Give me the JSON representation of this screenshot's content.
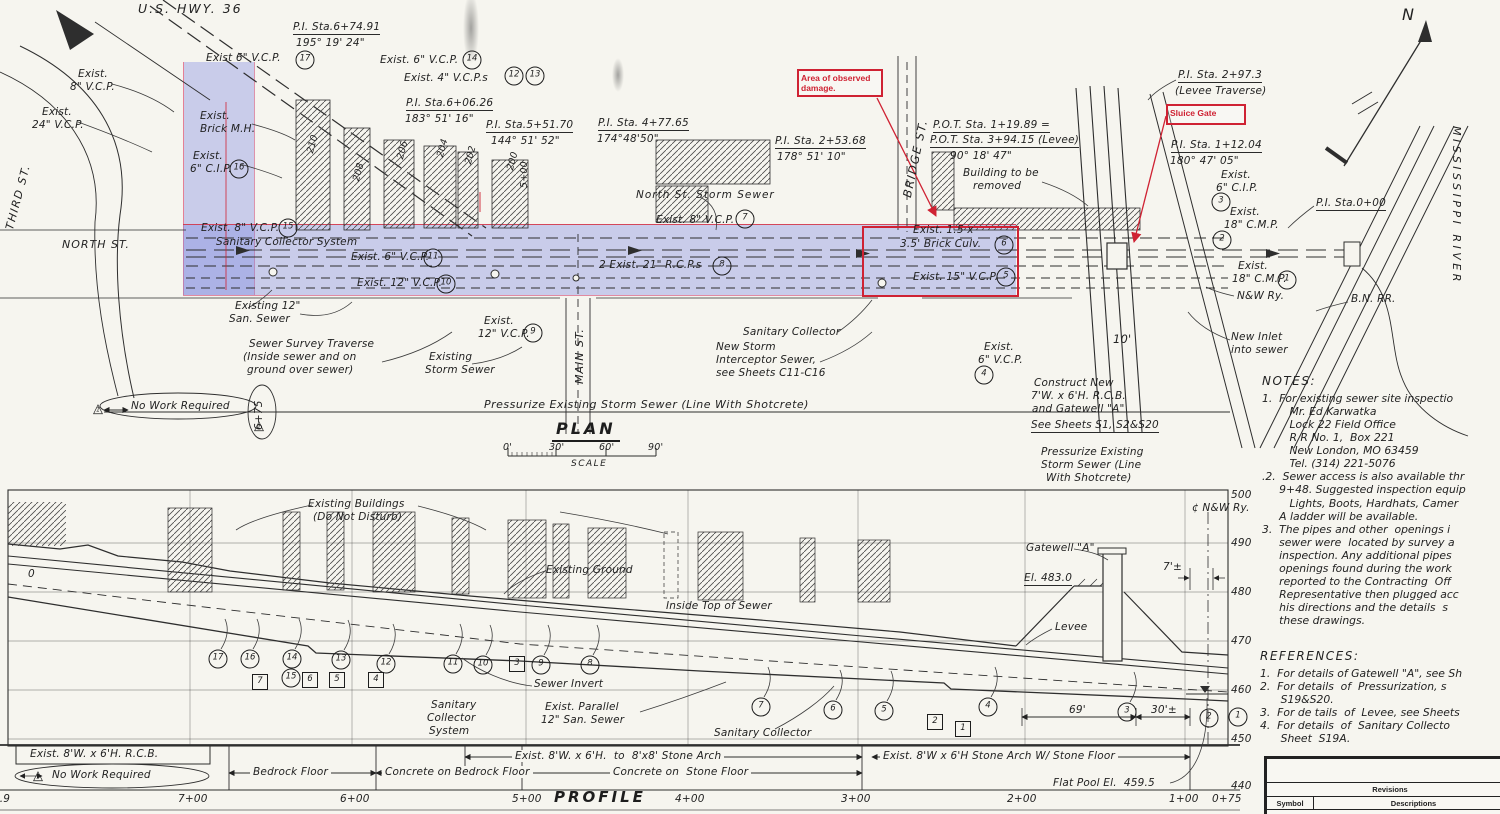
{
  "annotations": {
    "damage_label": "Area of observed damage.",
    "sluice_label": "Sluice Gate",
    "accent_red": "#cf2233",
    "highlight_blue": "rgba(122,132,224,0.36)"
  },
  "plan": {
    "title": "PLAN",
    "scale_label": "SCALE",
    "scale_ticks": [
      {
        "t": "0'",
        "x": 503
      },
      {
        "t": "30'",
        "x": 549
      },
      {
        "t": "60'",
        "x": 599
      },
      {
        "t": "90'",
        "x": 648
      }
    ],
    "labels": [
      {
        "t": "U.S. HWY. 36",
        "x": 138,
        "y": 2,
        "fs": 12.5,
        "ls": 2
      },
      {
        "t": "THIRD ST.",
        "x": 4,
        "y": 228,
        "r": -75,
        "fs": 11,
        "ls": 1.5
      },
      {
        "t": "Exist.",
        "x": 78,
        "y": 68
      },
      {
        "t": "8\" V.C.P.",
        "x": 70,
        "y": 81
      },
      {
        "t": "Exist.",
        "x": 42,
        "y": 106
      },
      {
        "t": "24\" V.C.P.",
        "x": 32,
        "y": 119
      },
      {
        "t": "Exist 6\" V.C.P.",
        "x": 206,
        "y": 52
      },
      {
        "t": "P.I. Sta.6+74.91",
        "x": 293,
        "y": 21,
        "u": 1
      },
      {
        "t": "195° 19' 24\"",
        "x": 296,
        "y": 37
      },
      {
        "t": "Exist. 6\" V.C.P.",
        "x": 380,
        "y": 54
      },
      {
        "t": "Exist. 4\" V.C.P.s",
        "x": 404,
        "y": 72
      },
      {
        "t": "P.I. Sta.6+06.26",
        "x": 406,
        "y": 97,
        "u": 1
      },
      {
        "t": "183° 51' 16\"",
        "x": 405,
        "y": 113
      },
      {
        "t": "P.I. Sta.5+51.70",
        "x": 486,
        "y": 119,
        "u": 1
      },
      {
        "t": "144° 51' 52\"",
        "x": 491,
        "y": 135
      },
      {
        "t": "P.I. Sta. 4+77.65",
        "x": 598,
        "y": 117,
        "u": 1
      },
      {
        "t": "174°48'50\"",
        "x": 597,
        "y": 133
      },
      {
        "t": "P.I. Sta. 2+53.68",
        "x": 775,
        "y": 135,
        "u": 1
      },
      {
        "t": "178° 51' 10\"",
        "x": 777,
        "y": 151
      },
      {
        "t": "Exist.",
        "x": 200,
        "y": 110
      },
      {
        "t": "Brick M.H.",
        "x": 200,
        "y": 123
      },
      {
        "t": "Exist.",
        "x": 193,
        "y": 150
      },
      {
        "t": "6\" C.I.P.",
        "x": 190,
        "y": 163
      },
      {
        "t": "Exist. 8\" V.C.P.",
        "x": 201,
        "y": 222
      },
      {
        "t": "Sanitary Collector System",
        "x": 216,
        "y": 236
      },
      {
        "t": "Exist. 6\" V.C.P.",
        "x": 351,
        "y": 251
      },
      {
        "t": "Exist. 12\" V.C.P.",
        "x": 357,
        "y": 277
      },
      {
        "t": "NORTH ST.",
        "x": 62,
        "y": 239,
        "fs": 11,
        "ls": 1
      },
      {
        "t": "Existing 12\"",
        "x": 235,
        "y": 300
      },
      {
        "t": "San. Sewer",
        "x": 229,
        "y": 313
      },
      {
        "t": "Sewer Survey Traverse",
        "x": 249,
        "y": 338
      },
      {
        "t": "(Inside sewer and on",
        "x": 243,
        "y": 351
      },
      {
        "t": "ground over sewer)",
        "x": 247,
        "y": 364
      },
      {
        "t": "Exist.",
        "x": 484,
        "y": 315
      },
      {
        "t": "12\" V.C.P.",
        "x": 478,
        "y": 328
      },
      {
        "t": "Existing",
        "x": 429,
        "y": 351
      },
      {
        "t": "Storm Sewer",
        "x": 425,
        "y": 364
      },
      {
        "t": "MAIN ST.",
        "x": 574,
        "y": 384,
        "r": -90,
        "fs": 11,
        "ls": 1
      },
      {
        "t": "North St. Storm Sewer",
        "x": 636,
        "y": 189,
        "ls": 1
      },
      {
        "t": "Exist. 8\" V.C.P.",
        "x": 656,
        "y": 214
      },
      {
        "t": "2 Exist. 21\" R.C.P.s",
        "x": 599,
        "y": 259
      },
      {
        "t": "Sanitary Collector",
        "x": 743,
        "y": 326
      },
      {
        "t": "New Storm",
        "x": 716,
        "y": 341
      },
      {
        "t": "Interceptor Sewer,",
        "x": 716,
        "y": 354
      },
      {
        "t": "see Sheets C11-C16",
        "x": 716,
        "y": 367
      },
      {
        "t": "BRIDGE ST.",
        "x": 901,
        "y": 196,
        "r": -78,
        "fs": 11.5,
        "ls": 1.5
      },
      {
        "t": "P.O.T. Sta. 1+19.89 =",
        "x": 933,
        "y": 119,
        "u": 1
      },
      {
        "t": "P.O.T. Sta. 3+94.15 (Levee)",
        "x": 930,
        "y": 134,
        "u": 1
      },
      {
        "t": "90° 18' 47\"",
        "x": 950,
        "y": 150
      },
      {
        "t": "Building to be",
        "x": 963,
        "y": 167
      },
      {
        "t": "removed",
        "x": 973,
        "y": 180
      },
      {
        "t": "Exist. 1.5 x",
        "x": 913,
        "y": 224
      },
      {
        "t": "3.5' Brick Culv.",
        "x": 900,
        "y": 238
      },
      {
        "t": "Exist. 15\" V.C.P.",
        "x": 913,
        "y": 271
      },
      {
        "t": "Exist.",
        "x": 984,
        "y": 341
      },
      {
        "t": "6\" V.C.P.",
        "x": 978,
        "y": 354
      },
      {
        "t": "Construct New",
        "x": 1034,
        "y": 377
      },
      {
        "t": "7'W. x 6'H. R.C.B.",
        "x": 1031,
        "y": 390
      },
      {
        "t": "and Gatewell \"A\"",
        "x": 1032,
        "y": 403
      },
      {
        "t": "See Sheets S1, S2&S20",
        "x": 1031,
        "y": 419,
        "u": 1
      },
      {
        "t": "Pressurize Existing",
        "x": 1041,
        "y": 446
      },
      {
        "t": "Storm Sewer (Line",
        "x": 1041,
        "y": 459
      },
      {
        "t": "With Shotcrete)",
        "x": 1046,
        "y": 472
      },
      {
        "t": "10'",
        "x": 1113,
        "y": 333,
        "fs": 11.5
      },
      {
        "t": "P.I. Sta. 2+97.3",
        "x": 1178,
        "y": 69,
        "u": 1
      },
      {
        "t": "(Levee Traverse)",
        "x": 1175,
        "y": 85
      },
      {
        "t": "P.I. Sta. 1+12.04",
        "x": 1171,
        "y": 139,
        "u": 1
      },
      {
        "t": "180° 47' 05\"",
        "x": 1170,
        "y": 155
      },
      {
        "t": "Exist.",
        "x": 1221,
        "y": 169
      },
      {
        "t": "6\" C.I.P.",
        "x": 1216,
        "y": 182
      },
      {
        "t": "Exist.",
        "x": 1230,
        "y": 206
      },
      {
        "t": "18\" C.M.P.",
        "x": 1224,
        "y": 219
      },
      {
        "t": "P.I. Sta.0+00",
        "x": 1316,
        "y": 197,
        "u": 1
      },
      {
        "t": "Exist.",
        "x": 1238,
        "y": 260
      },
      {
        "t": "18\" C.M.P.",
        "x": 1232,
        "y": 273
      },
      {
        "t": "N&W Ry.",
        "x": 1237,
        "y": 290
      },
      {
        "t": "B.N. RR.",
        "x": 1351,
        "y": 293
      },
      {
        "t": "New Inlet",
        "x": 1231,
        "y": 331
      },
      {
        "t": "into sewer",
        "x": 1231,
        "y": 344
      },
      {
        "t": "MISSISSIPPI RIVER",
        "x": 1462,
        "y": 126,
        "r": 90,
        "fs": 11,
        "ls": 3.5
      },
      {
        "t": "N",
        "x": 1402,
        "y": 6,
        "fs": 16
      },
      {
        "t": "No Work Required",
        "x": 131,
        "y": 400
      },
      {
        "t": "6+75",
        "x": 253,
        "y": 430,
        "r": -90
      },
      {
        "t": "Pressurize Existing Storm Sewer (Line With Shotcrete)",
        "x": 484,
        "y": 399,
        "fs": 11,
        "ls": 0.5
      },
      {
        "t": "210",
        "x": 306,
        "y": 152,
        "r": -75,
        "fs": 9.5
      },
      {
        "t": "208",
        "x": 352,
        "y": 180,
        "r": -75,
        "fs": 9.5
      },
      {
        "t": "206",
        "x": 396,
        "y": 158,
        "r": -75,
        "fs": 9.5
      },
      {
        "t": "204",
        "x": 436,
        "y": 156,
        "r": -75,
        "fs": 9.5
      },
      {
        "t": "202",
        "x": 464,
        "y": 163,
        "r": -75,
        "fs": 9.5
      },
      {
        "t": "200",
        "x": 506,
        "y": 169,
        "r": -75,
        "fs": 9.5
      },
      {
        "t": "5+00",
        "x": 520,
        "y": 188,
        "r": -90,
        "fs": 9.5
      }
    ],
    "markers": [
      {
        "n": "17",
        "x": 305,
        "y": 60
      },
      {
        "n": "14",
        "x": 472,
        "y": 60
      },
      {
        "n": "12",
        "x": 514,
        "y": 76
      },
      {
        "n": "13",
        "x": 535,
        "y": 76
      },
      {
        "n": "16",
        "x": 239,
        "y": 169
      },
      {
        "n": "15",
        "x": 288,
        "y": 228
      },
      {
        "n": "11",
        "x": 433,
        "y": 258
      },
      {
        "n": "10",
        "x": 446,
        "y": 284
      },
      {
        "n": "9",
        "x": 533,
        "y": 333
      },
      {
        "n": "7",
        "x": 745,
        "y": 219
      },
      {
        "n": "8",
        "x": 722,
        "y": 266
      },
      {
        "n": "6",
        "x": 1004,
        "y": 245
      },
      {
        "n": "5",
        "x": 1006,
        "y": 277
      },
      {
        "n": "4",
        "x": 984,
        "y": 375
      },
      {
        "n": "3",
        "x": 1221,
        "y": 202
      },
      {
        "n": "2",
        "x": 1222,
        "y": 240
      },
      {
        "n": "1",
        "x": 1287,
        "y": 280
      },
      {
        "n": "1",
        "x": 98,
        "y": 409,
        "s": "t"
      },
      {
        "n": "1",
        "x": 259,
        "y": 426,
        "s": "t"
      }
    ]
  },
  "profile": {
    "title": "PROFILE",
    "labels": [
      {
        "t": "Existing Buildings",
        "x": 308,
        "y": 498
      },
      {
        "t": "(Do Not Disturb)",
        "x": 313,
        "y": 511
      },
      {
        "t": "Existing Ground",
        "x": 546,
        "y": 564
      },
      {
        "t": "Inside Top of Sewer",
        "x": 666,
        "y": 600
      },
      {
        "t": "Sewer Invert",
        "x": 534,
        "y": 678
      },
      {
        "t": "Sanitary",
        "x": 431,
        "y": 699
      },
      {
        "t": "Collector",
        "x": 427,
        "y": 712
      },
      {
        "t": "System",
        "x": 429,
        "y": 725
      },
      {
        "t": "Exist. Parallel",
        "x": 545,
        "y": 701
      },
      {
        "t": "12\" San. Sewer",
        "x": 541,
        "y": 714
      },
      {
        "t": "Sanitary Collector",
        "x": 714,
        "y": 727
      },
      {
        "t": "Gatewell \"A\"",
        "x": 1026,
        "y": 542
      },
      {
        "t": "El. 483.0",
        "x": 1024,
        "y": 572,
        "u": 1
      },
      {
        "t": "Levee",
        "x": 1055,
        "y": 621
      },
      {
        "t": "7'±",
        "x": 1163,
        "y": 561
      },
      {
        "t": "¢ N&W Ry.",
        "x": 1192,
        "y": 502
      },
      {
        "t": "69'",
        "x": 1066,
        "y": 704,
        "bg": 1
      },
      {
        "t": "30'±",
        "x": 1148,
        "y": 704,
        "bg": 1
      },
      {
        "t": "Flat Pool El.  459.5",
        "x": 1053,
        "y": 777
      },
      {
        "t": "0",
        "x": 28,
        "y": 568
      },
      {
        "t": "Exist. 8'W. x 6'H. R.C.B.",
        "x": 30,
        "y": 748
      },
      {
        "t": "No Work Required",
        "x": 52,
        "y": 769
      },
      {
        "t": "Bedrock Floor",
        "x": 250,
        "y": 766,
        "bg": 1
      },
      {
        "t": "Concrete on Bedrock Floor",
        "x": 382,
        "y": 766,
        "bg": 1
      },
      {
        "t": "Exist. 8'W. x 6'H.  to  8'x8' Stone Arch",
        "x": 512,
        "y": 750,
        "bg": 1
      },
      {
        "t": "Concrete on  Stone Floor",
        "x": 610,
        "y": 766,
        "bg": 1
      },
      {
        "t": "Exist. 8'W x 6'H Stone Arch W/ Stone Floor",
        "x": 880,
        "y": 750,
        "bg": 1
      }
    ],
    "markers": [
      {
        "n": "17",
        "x": 218,
        "y": 659,
        "ld": 1
      },
      {
        "n": "16",
        "x": 250,
        "y": 659,
        "ld": 1
      },
      {
        "n": "14",
        "x": 292,
        "y": 659,
        "ld": 1
      },
      {
        "n": "15",
        "x": 291,
        "y": 678
      },
      {
        "n": "13",
        "x": 341,
        "y": 660,
        "ld": 1
      },
      {
        "n": "12",
        "x": 386,
        "y": 664,
        "ld": 1
      },
      {
        "n": "11",
        "x": 453,
        "y": 664,
        "ld": 1
      },
      {
        "n": "10",
        "x": 483,
        "y": 665,
        "ld": 1
      },
      {
        "n": "9",
        "x": 541,
        "y": 665,
        "ld": 1
      },
      {
        "n": "8",
        "x": 590,
        "y": 665,
        "ld": 1
      },
      {
        "n": "7",
        "x": 761,
        "y": 707,
        "ld": 1
      },
      {
        "n": "6",
        "x": 833,
        "y": 710,
        "ld": 1
      },
      {
        "n": "5",
        "x": 884,
        "y": 711,
        "ld": 1
      },
      {
        "n": "4",
        "x": 988,
        "y": 707,
        "ld": 1
      },
      {
        "n": "3",
        "x": 1127,
        "y": 712,
        "ld": 1
      },
      {
        "n": "2",
        "x": 1209,
        "y": 718
      },
      {
        "n": "1",
        "x": 1238,
        "y": 717
      },
      {
        "n": "7",
        "x": 260,
        "y": 682,
        "s": "q"
      },
      {
        "n": "6",
        "x": 310,
        "y": 680,
        "s": "q"
      },
      {
        "n": "5",
        "x": 337,
        "y": 680,
        "s": "q"
      },
      {
        "n": "4",
        "x": 376,
        "y": 680,
        "s": "q"
      },
      {
        "n": "3",
        "x": 517,
        "y": 664,
        "s": "q"
      },
      {
        "n": "2",
        "x": 935,
        "y": 722,
        "s": "q"
      },
      {
        "n": "1",
        "x": 963,
        "y": 729,
        "s": "q"
      },
      {
        "n": "1",
        "x": 38,
        "y": 776,
        "s": "t"
      }
    ],
    "stations": [
      {
        "t": "92.9",
        "x": -14
      },
      {
        "t": "7+00",
        "x": 178
      },
      {
        "t": "6+00",
        "x": 340
      },
      {
        "t": "5+00",
        "x": 512
      },
      {
        "t": "4+00",
        "x": 675
      },
      {
        "t": "3+00",
        "x": 841
      },
      {
        "t": "2+00",
        "x": 1007
      },
      {
        "t": "1+00",
        "x": 1169
      },
      {
        "t": "0+75",
        "x": 1212
      }
    ],
    "elevations": [
      {
        "t": "500",
        "y": 489
      },
      {
        "t": "490",
        "y": 537
      },
      {
        "t": "480",
        "y": 586
      },
      {
        "t": "470",
        "y": 635
      },
      {
        "t": "460",
        "y": 684
      },
      {
        "t": "450",
        "y": 733
      },
      {
        "t": "440",
        "y": 780
      }
    ]
  },
  "notes": {
    "heading": "NOTES:",
    "lines": [
      "1.  For existing sewer site inspectio",
      "        Mr. Ed Karwatka",
      "        Lock 22 Field Office",
      "        R R No. 1,  Box 221",
      "        New London, MO 63459",
      "        Tel. (314) 221-5076",
      ".2.  Sewer access is also available thr",
      "     9+48. Suggested inspection equip",
      "        Lights, Boots, Hardhats, Camer",
      "     A ladder will be available.",
      "3.  The pipes and other  openings i",
      "     sewer were  located by survey a",
      "     inspection. Any additional pipes",
      "     openings found during the work",
      "     reported to the Contracting  Off",
      "     Representative then plugged acc",
      "     his directions and the details  s",
      "     these drawings."
    ]
  },
  "references": {
    "heading": "REFERENCES:",
    "lines": [
      "1.  For details of Gatewell \"A\", see Sh",
      "2.  For details  of  Pressurization, s",
      "      S19&S20.",
      "3.  For de tails  of  Levee, see Sheets",
      "4.  For details  of  Sanitary Collecto",
      "      Sheet  S19A."
    ]
  },
  "revisions": {
    "title": "Revisions",
    "symbol": "Symbol",
    "descriptions": "Descriptions"
  }
}
